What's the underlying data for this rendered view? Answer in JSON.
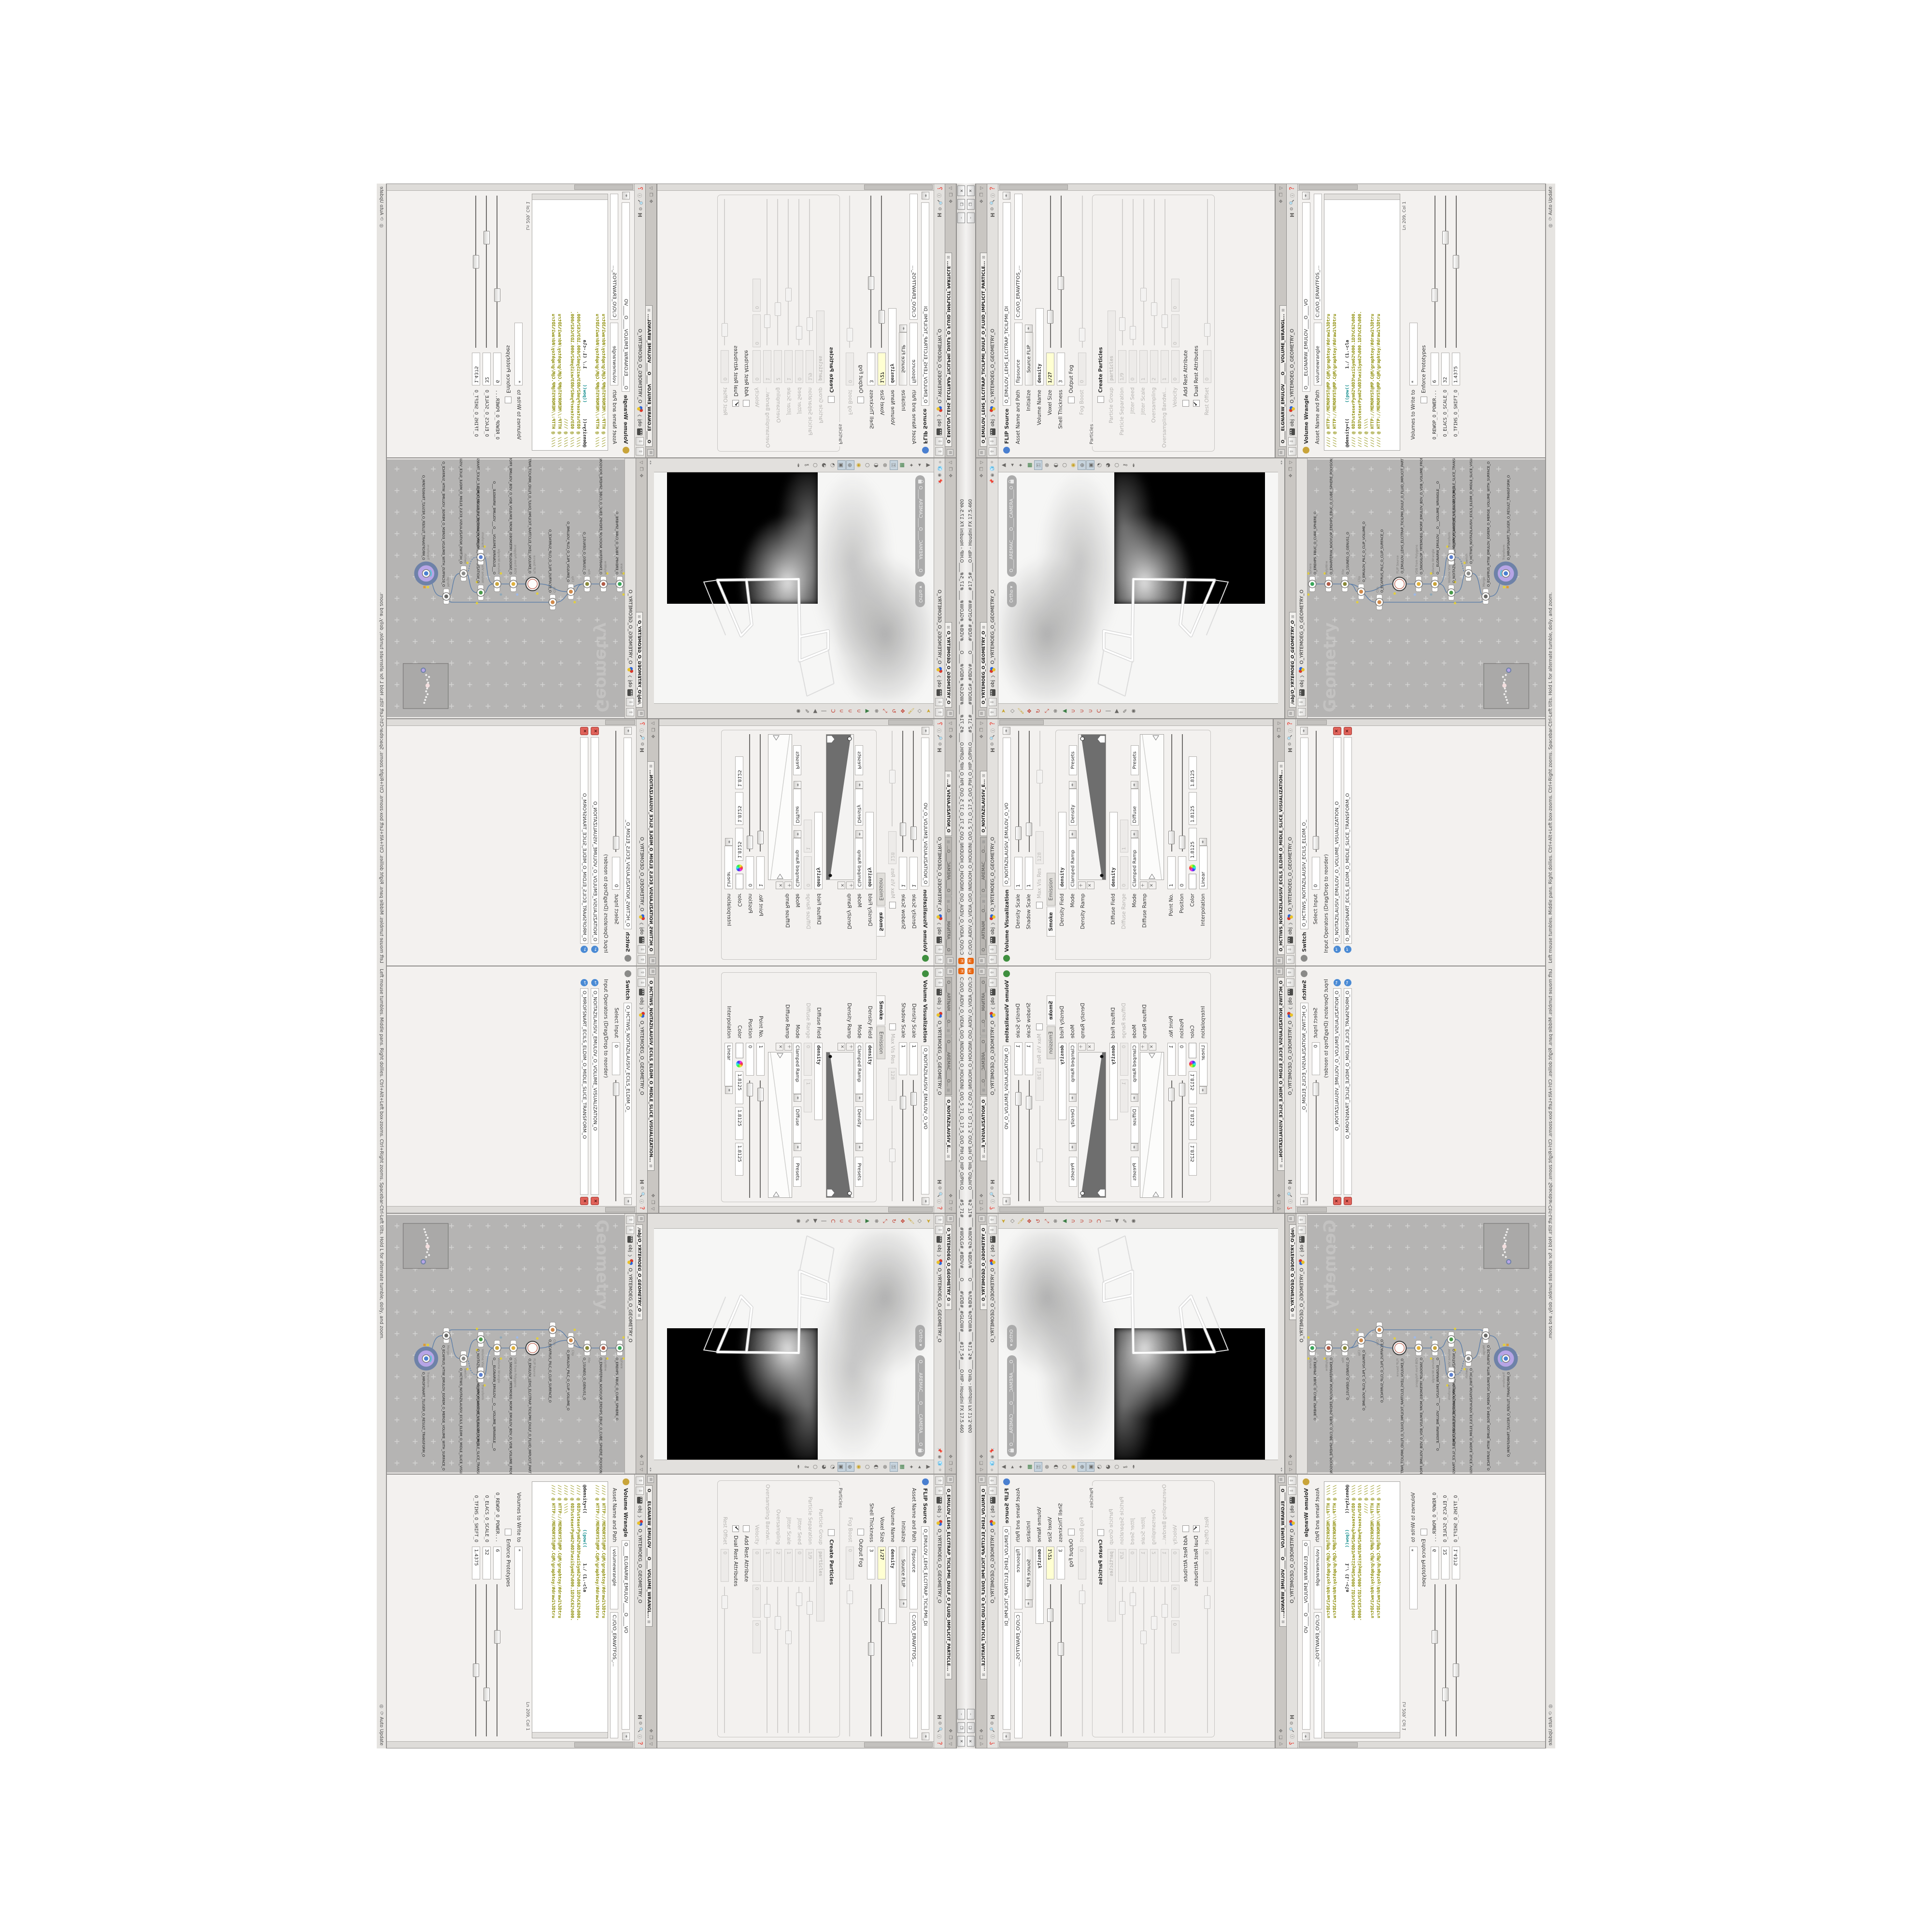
{
  "colors": {
    "accent_orange": "#e8650f",
    "yellow_field": "#ffffd2",
    "node_select_fill": "#b7a5e6",
    "node_select_ring": "#6e82a8",
    "wire": "#5b7da8",
    "net_canvas": "#b5b4b3",
    "code_comment": "#8a8a00",
    "code_fn": "#0f8c8c",
    "delete_red": "#e0625a",
    "flag_yellow": "#e3cf3d"
  },
  "window": {
    "title": "C:/O/O_AIDIV_O_VIDIA_O/O_INIDUOH_O_HOUDINI_O/O_5_71_O_17_5_O/O_PIH_O_HIP_O/PIH.O____#5_71#____#WOLG#_#BDV#____O____#VDB#_#GLOW#____#17_5#____O.HIP - Houdini FX 17.5.460",
    "logo_glyph": "H",
    "buttons": {
      "minimize": "–",
      "restore": "❐",
      "close": "✕"
    }
  },
  "statusbar": {
    "help": "Left mouse tumbles. Middle pans. Right dollies. Ctrl+Alt+Left box-zooms. Ctrl+Right zooms. Spacebar-Ctrl-Left tilts. Hold L for alternate tumble, dolly, and zoom.",
    "update_mode": "Auto Update"
  },
  "path": {
    "root": "obj",
    "node": "O_YRTEMOEG_O_GEOMETRY_O",
    "network": "/obj/O_YRTEMOEG_O_GEOMETRY_O"
  },
  "vis": {
    "tabs": [
      "O____ARTNAM____O...",
      "O____AREMAC____O...",
      "O_NOITAZILAUSIV_E..."
    ],
    "label": "Volume Visualization",
    "name": "O_NOITAZILAUSIV_EMULOV_O_VO",
    "density_scale": {
      "label": "Density Scale",
      "value": "1"
    },
    "shadow_scale": {
      "label": "Shadow Scale",
      "value": "1"
    },
    "max_vis_res": {
      "label": "Max Vis Res",
      "value": "128"
    },
    "tab_smoke": "Smoke",
    "tab_emission": "Emission",
    "density_field": {
      "label": "Density Field",
      "value": "density"
    },
    "mode": {
      "label": "Mode",
      "value": "Clamped Ramp"
    },
    "ramp_target": "Density",
    "presets": "Presets",
    "density_ramp_label": "Density Ramp",
    "diffuse_field": {
      "label": "Diffuse Field",
      "value": "density"
    },
    "diffuse_range": {
      "label": "Diffuse Range",
      "v1": "0",
      "v2": "1"
    },
    "mode2": {
      "label": "Mode",
      "value": "Clamped Ramp"
    },
    "ramp_target2": "Diffuse",
    "presets2": "Presets",
    "diffuse_ramp_label": "Diffuse Ramp",
    "point_no": {
      "label": "Point No.",
      "value": "1"
    },
    "position": {
      "label": "Position",
      "value": "0"
    },
    "color_label": "Color",
    "color_values": [
      "1.8125",
      "1.8125",
      "1.8125"
    ],
    "interpolation": {
      "label": "Interpolation",
      "value": "Linear"
    }
  },
  "switch": {
    "tab": "O_HCTIWS_NOITAZILAUSIV_ECILS_ELDIM_O_MIDLE_SLICE_VISUALIZATION...",
    "label": "Switch",
    "name": "O_HCTIWS_NOITAZILAUSIV_ECILS_ELDIM_O_",
    "select_input": {
      "label": "Select Input",
      "value": "0"
    },
    "list_label": "Input Operators (Drag/Drop to reorder)",
    "inputs": [
      "O_NOITAZILAUSIV_EMULOV_O_VOLUME_VISUALIZATION_O",
      "O_MROFSNART_ECILS_ELDIM_O_MIDLE_SLICE_TRANSFORM_O"
    ]
  },
  "flip": {
    "tab": "O_EMULOV_LEHS_ELCITRAP_TICILPMI_DIULF_O_FLUID_IMPLICIT_PARTICLE...",
    "label": "FLIP Source",
    "name": "O_EMULOV_LEHS_ELCITRAP_TICILPMI_DI",
    "asset_label": "Asset Name and Path",
    "asset_name": "flipsource",
    "asset_path": "C:/O/O_ERAWTFOS_...",
    "initialize": {
      "label": "Initialize",
      "value": "Source FLIP"
    },
    "volume_name": {
      "label": "Volume Name",
      "value": "density"
    },
    "voxel_size": {
      "label": "Voxel Size",
      "value": "1/27"
    },
    "shell_thickness": {
      "label": "Shell Thickness",
      "value": "3"
    },
    "output_fog": "Output Fog",
    "fog_boost": {
      "label": "Fog Boost",
      "value": "0"
    },
    "particles_group": "Particles",
    "create_particles": "Create Particles",
    "particle_group": {
      "label": "Particle Group",
      "value": "particles"
    },
    "particle_separation": {
      "label": "Particle Separation",
      "value": "1/9"
    },
    "jitter_seed": {
      "label": "Jitter Seed",
      "value": "0"
    },
    "jitter_scale": {
      "label": "Jitter Scale",
      "value": "1"
    },
    "oversampling": {
      "label": "Oversampling",
      "value": "2"
    },
    "oversampling_bw": {
      "label": "Oversampling Bandwi...",
      "value": "1"
    },
    "velocity": {
      "label": "Velocity",
      "v1": "0",
      "v2": "0",
      "v3": "0"
    },
    "add_rest": "Add Rest Attribute",
    "dual_rest": "Dual Rest Attributes",
    "rest_offset": {
      "label": "Rest Offset",
      "value": "0"
    }
  },
  "wrangle": {
    "tab": "O____ELGNARW_EMULOV____O____VOLUME_WRANGL...",
    "label": "Volume Wrangle",
    "name": "O____ELGNARW_EMULOV____O____VO",
    "asset_label": "Asset Name and Path",
    "asset_name": "volumewrangle",
    "asset_path": "C:/O/O_ERAWTFOS_...",
    "code": [
      "//// @ HTTP://MEMORYST@MP.C@M/graphtoy/#draw1%3Dtru",
      "//// @ HTTP://MEMORYST@MP.C@M/graphtoy/#draw1%3Dtru",
      "",
      "//// @ 0D3%steserPym62%0D3%eziSym62%000.1D3%C62%000.",
      "//// @ 0D3%steserPym62%0D3%eziSym62%000.1D3%C62%000.",
      "//// @ \\\\\\\\",
      "//// @ HTTP://MEMORYST@MP.C@M/graphtoy/#draw1%3Dtru",
      "//// @ HTTP://MEMORYST@MP.C@M/graphtoy/#draw1%3Dtru"
    ],
    "expr": {
      "a": "@density=((",
      "b": "((pow((",
      "c": "1./ (1.-cla"
    },
    "ln_col": "Ln 209, Col 1",
    "volumes_label": "Volumes to Write to",
    "volumes_value": "*",
    "enforce": "Enforce Prototypes",
    "sliders": [
      {
        "label": "O_REWOP_O_POWER...",
        "value": "6"
      },
      {
        "label": "O_ELACS_O_SCALE_O",
        "value": "32"
      },
      {
        "label": "O_TFIHS_O_SHIFT_O",
        "value": "1.4375"
      }
    ]
  },
  "viewport": {
    "tab": "O_YRTEMOEG_O_GEOMETRY_O",
    "ortho": "Ortho",
    "camera": "O____AREMAC____O____CAMERA____O"
  },
  "network": {
    "tab": "/obj/O_YRTEMOEG_O_GEOMETRY_O",
    "watermark": "Geometry",
    "nodes": [
      {
        "type": "Sphere",
        "name": "O_EREHPS_EBUC_O_CUBE_SPHERE_O"
      },
      {
        "type": "PolyWire",
        "name": "O_EMARFERIW_NOGYLOP_EREHPS_EBUC_O_CUBE_SPHERE_POLYGON_WIREFRAME_O"
      },
      {
        "type": "File",
        "name": "O_1SUNEG_O_GENUS1_O"
      },
      {
        "type": "Clip",
        "name": "O_EMULOV_PILC_O_CLIP_VOLUME_O"
      },
      {
        "type": "Clip",
        "name": "O_ECAFRUS_PILC_O_CLIP_SURFACE_O"
      },
      {
        "type": "FLIP Source",
        "name": "O_EMULOV_LEHS_ELCITRAP_TICILPMI_DIULF_O_FLUID_IMPLICIT_PARTICLE_SHEL_VOLUME_O"
      },
      {
        "type": "VDB from Polygons",
        "name": "O_SNOGILOP_YRTEMOEG_MORF_EMULOV_BDV_O_VDB_VOLUME_FROM_GEOMETRY_POLYGONS_O"
      },
      {
        "type": "Volume Wrangle",
        "name": "O___ELGNARW_EMULOV___O___VOLUME_WRANGLE___O"
      },
      {
        "type": "Volume Visualization",
        "name": "O_NOITAZILAUSIV_EMULOV_O_VOLUME_VISUALIZATION_O"
      },
      {
        "type": "Transform",
        "name": "O_MROFSNART_ECILS_ELDIM_O_MIDLE_SLICE_TRANSFORM_O"
      },
      {
        "type": "Switch",
        "name": "O_HCTIWS_NOITAZILAUSIV_ECILS_ELDIM_O_MIDLE_SLICE_VISUALIZATION_SWITCH_O"
      },
      {
        "type": "Merge",
        "name": "O_ECAFRUS_HTIW_EMULOV_EGREM_O_MERGE_VOLUME_WITH_SURFACE_O"
      },
      {
        "type": "Transform",
        "name": "O_MROFSNART_TLUSER_O_RESULT_TRANSFORM_O"
      }
    ]
  }
}
